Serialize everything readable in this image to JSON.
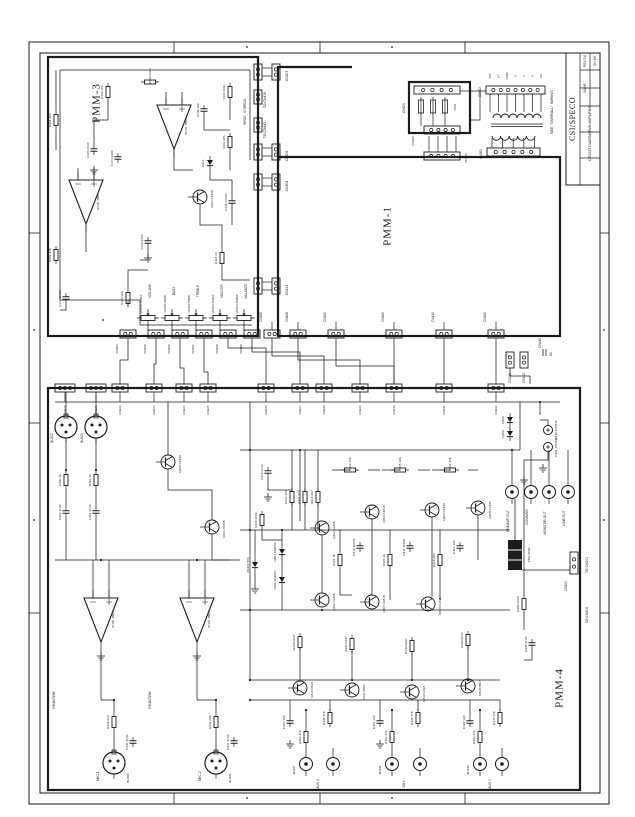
{
  "page": {
    "background": "#ffffff",
    "ink": "#1b1b1b"
  },
  "modules": [
    {
      "label": "PMM-3"
    },
    {
      "label": "PMM-1"
    },
    {
      "label": "PMM-4"
    }
  ],
  "title_block": {
    "company": "CSI/SPECO",
    "rows": [
      {
        "value": "REV 2.6"
      },
      {
        "value": "SH 1/8"
      },
      {
        "value": "NAME"
      },
      {
        "value": "PMM AMPLIFIER"
      },
      {
        "value": "CIRCUIT DIAGRAM"
      }
    ]
  },
  "notes": [
    {
      "text": "SEE \"OVERALL\" WIRING"
    },
    {
      "text": "TO CN416"
    },
    {
      "text": "TO CN442"
    },
    {
      "text": "ST/BRDG"
    },
    {
      "text": "BRDG"
    },
    {
      "text": "TO CN201"
    },
    {
      "text": "TO CN308"
    },
    {
      "text": "AC"
    },
    {
      "text": "PHANTOM"
    },
    {
      "text": "PHANTOM"
    },
    {
      "text": "VOLUME"
    },
    {
      "text": "BASS"
    },
    {
      "text": "TREBLE"
    },
    {
      "text": "MASTER"
    },
    {
      "text": "BALANCE"
    },
    {
      "text": "MIC 1"
    },
    {
      "text": "MIC 2"
    },
    {
      "text": "AUX 2"
    },
    {
      "text": "AUX"
    },
    {
      "text": "AUX 1"
    },
    {
      "text": "PREAMP OUT"
    },
    {
      "text": "COMMON"
    },
    {
      "text": "MONITOR OUT"
    },
    {
      "text": "LINE OUT"
    },
    {
      "text": "CN416"
    }
  ],
  "transformer": {
    "top_pins": [
      {
        "label": "16V"
      },
      {
        "label": "CT"
      },
      {
        "label": "COM"
      },
      {
        "label": "0"
      },
      {
        "label": "4"
      },
      {
        "label": "8"
      },
      {
        "label": "AC"
      }
    ],
    "top_connector": "CN302",
    "bottom_connector": "CN301",
    "fuse_connector": "CN300",
    "edge_connector": "CN305",
    "fuse_label": "F601",
    "fusebox_label": "CN600"
  },
  "connectors": {
    "pmm3_right": [
      {
        "label": "CN307"
      },
      {
        "label": "CN309"
      },
      {
        "label": "CN304"
      },
      {
        "label": "CN314"
      }
    ],
    "pmm3_bottom": [
      {
        "label": "CN204"
      },
      {
        "label": "CN205"
      },
      {
        "label": "CN206"
      },
      {
        "label": "CN207"
      },
      {
        "label": "CN208"
      },
      {
        "label": "CN209"
      }
    ],
    "pmm1_bottom": [
      {
        "label": "CN406"
      },
      {
        "label": "CN408"
      },
      {
        "label": "CN405"
      },
      {
        "label": "CN409"
      },
      {
        "label": "CN410"
      },
      {
        "label": "CN400"
      }
    ],
    "pmm1_right": [
      {
        "label": "CN411"
      },
      {
        "label": "CN412"
      }
    ],
    "pmm4_top": [
      {
        "label": "CN220"
      },
      {
        "label": "CN221"
      },
      {
        "label": "CN222"
      },
      {
        "label": "CN223"
      },
      {
        "label": "CN224"
      },
      {
        "label": "CN225"
      },
      {
        "label": "CN226"
      },
      {
        "label": "CN227"
      },
      {
        "label": "CN228"
      },
      {
        "label": "CN229"
      },
      {
        "label": "CN230"
      },
      {
        "label": "CN231"
      },
      {
        "label": "CN232"
      }
    ],
    "pmm4_edge": [
      {
        "label": "CN404"
      }
    ]
  },
  "jacks": {
    "din": [
      {
        "label": "BU402"
      },
      {
        "label": "BU403"
      }
    ],
    "mic": [
      {
        "label": "BU400"
      },
      {
        "label": "BU401"
      }
    ],
    "inputs": [
      {
        "label": "BU407"
      },
      {
        "label": "BU408"
      },
      {
        "label": "BU410"
      }
    ]
  },
  "pots": [
    {
      "label": "VR100 250KA"
    },
    {
      "label": "VR101 50KB"
    },
    {
      "label": "VR102 50KB"
    },
    {
      "label": "VR103 250KA"
    },
    {
      "label": "VR104 250KB"
    }
  ],
  "components": {
    "pmm3": [
      {
        "type": "res-v",
        "label": "R101 2K2"
      },
      {
        "type": "res-v",
        "label": "R102 47K"
      },
      {
        "type": "res-v",
        "label": "R103 10K"
      },
      {
        "type": "res-v",
        "label": "R104 10K"
      },
      {
        "type": "res-v",
        "label": "R110 100K"
      },
      {
        "type": "res-v",
        "label": "R111 22K"
      },
      {
        "type": "res-v",
        "label": "R113 1K"
      },
      {
        "type": "res-h",
        "label": "R140 220R"
      },
      {
        "type": "cap-v",
        "label": "C100 47UF"
      },
      {
        "type": "cap-v",
        "label": "C104 10PF"
      },
      {
        "type": "cap-v",
        "label": "C112 100PF"
      },
      {
        "type": "cap-v",
        "label": "C138 1UF"
      },
      {
        "type": "cap-v",
        "label": "C139 22PF"
      },
      {
        "type": "cap-v",
        "label": "C141 470PF"
      },
      {
        "type": "diode",
        "label": "D101"
      },
      {
        "type": "npn",
        "label": "Q101 C1815"
      },
      {
        "type": "opamp",
        "label": "IC100 4558"
      },
      {
        "type": "opamp",
        "label": "IC101 4558"
      }
    ],
    "pmm4": [
      {
        "type": "res-v",
        "label": "R400 1K"
      },
      {
        "type": "res-v",
        "label": "R401 1K"
      },
      {
        "type": "res-v",
        "label": "R410 1K2"
      },
      {
        "type": "res-v",
        "label": "R411 2K2"
      },
      {
        "type": "res-v",
        "label": "R413 4K7"
      },
      {
        "type": "res-v",
        "label": "R420 100K"
      },
      {
        "type": "res-v",
        "label": "R422 1K"
      },
      {
        "type": "res-v",
        "label": "R423 1K"
      },
      {
        "type": "res-v",
        "label": "R424 2K2"
      },
      {
        "type": "res-v",
        "label": "R430 0R47"
      },
      {
        "type": "res-v",
        "label": "R431 0R47"
      },
      {
        "type": "res-v",
        "label": "R432 0R47"
      },
      {
        "type": "res-v",
        "label": "R433 0R47"
      },
      {
        "type": "res-v",
        "label": "R445 47K"
      },
      {
        "type": "res-v",
        "label": "R446 47K"
      },
      {
        "type": "res-v",
        "label": "R447 47K"
      },
      {
        "type": "res-v",
        "label": "R450 220R"
      },
      {
        "type": "res-v",
        "label": "R440 2K2"
      },
      {
        "type": "res-v",
        "label": "R441 2K2"
      },
      {
        "type": "res-v",
        "label": "R460 47K"
      },
      {
        "type": "res-v",
        "label": "R461 47K"
      },
      {
        "type": "res-v",
        "label": "R462 47K"
      },
      {
        "type": "res-h",
        "label": "R414 10K"
      },
      {
        "type": "res-h",
        "label": "R415 10K"
      },
      {
        "type": "res-h",
        "label": "R416 47K"
      },
      {
        "type": "cap-v",
        "label": "C400 47UF"
      },
      {
        "type": "cap-v",
        "label": "C401 47UF"
      },
      {
        "type": "cap-v",
        "label": "C402 10UF"
      },
      {
        "type": "cap-v",
        "label": "C410 100PF"
      },
      {
        "type": "cap-v",
        "label": "C411 100PF"
      },
      {
        "type": "cap-v",
        "label": "C412 1UF"
      },
      {
        "type": "cap-v",
        "label": "C420 1UF"
      },
      {
        "type": "cap-v",
        "label": "C421 1UF"
      },
      {
        "type": "cap-v",
        "label": "C422 1UF"
      },
      {
        "type": "cap-v",
        "label": "C425 47UF"
      },
      {
        "type": "cap-v",
        "label": "C440 47UF"
      },
      {
        "type": "cap-v",
        "label": "C441 47UF"
      },
      {
        "type": "capbig",
        "label": "C430 2200UF"
      },
      {
        "type": "capbig",
        "label": "C431 2200UF"
      },
      {
        "type": "diode",
        "label": "D401 1N4002"
      },
      {
        "type": "diode",
        "label": "D402 1N4002"
      },
      {
        "type": "diode",
        "label": "ZD401 5V6"
      },
      {
        "type": "diode",
        "label": "D405"
      },
      {
        "type": "diode",
        "label": "D406"
      },
      {
        "type": "npn",
        "label": "Q400 C1815"
      },
      {
        "type": "npn",
        "label": "Q401 C1815"
      },
      {
        "type": "npn",
        "label": "Q402 C1815"
      },
      {
        "type": "npn",
        "label": "Q403 A1015"
      },
      {
        "type": "npn",
        "label": "Q404 C1815"
      },
      {
        "type": "npn",
        "label": "Q405 C1815"
      },
      {
        "type": "npn",
        "label": "Q406 C1815"
      },
      {
        "type": "npn",
        "label": "Q407 A1015"
      },
      {
        "type": "npn",
        "label": "Q408 C1815"
      },
      {
        "type": "npn",
        "label": "Q410 D313"
      },
      {
        "type": "npn",
        "label": "Q411 B507"
      },
      {
        "type": "npn",
        "label": "Q412 D313"
      },
      {
        "type": "npn",
        "label": "Q413 B507"
      },
      {
        "type": "opamp",
        "label": "IC400 4558"
      },
      {
        "type": "opamp",
        "label": "IC401 4558"
      },
      {
        "type": "trafo",
        "label": "T401 600R"
      }
    ]
  }
}
